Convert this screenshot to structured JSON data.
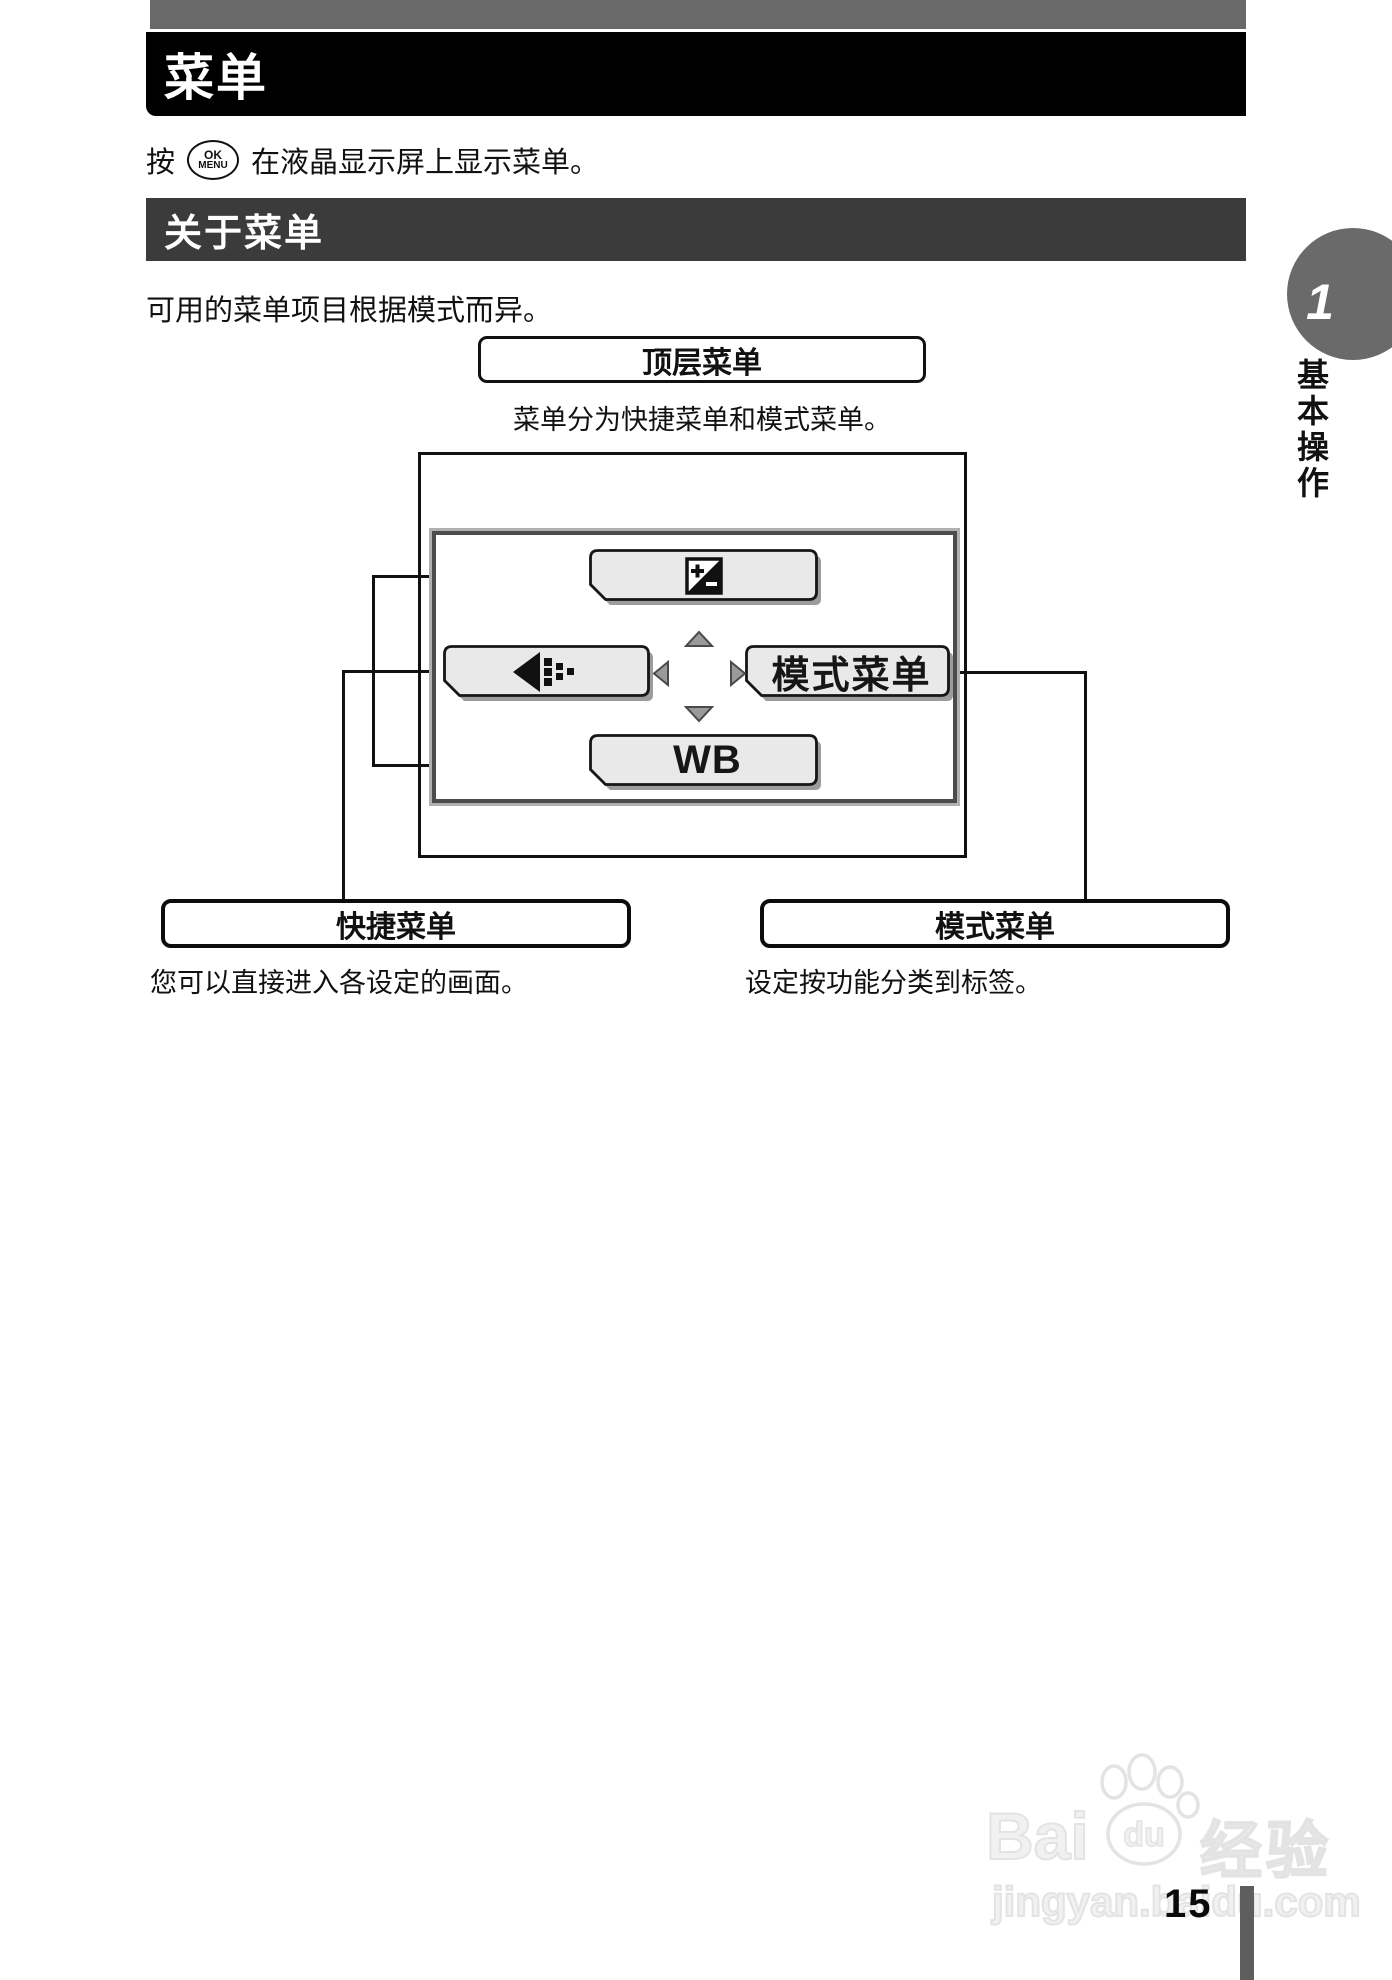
{
  "header": {
    "title": "菜单"
  },
  "intro": {
    "prefix": "按",
    "button_top": "OK",
    "button_bottom": "MENU",
    "suffix": "在液晶显示屏上显示菜单。"
  },
  "section": {
    "title": "关于菜单",
    "body": "可用的菜单项目根据模式而异。"
  },
  "top_menu": {
    "label": "顶层菜单",
    "caption": "菜单分为快捷菜单和模式菜单。"
  },
  "screen": {
    "mode_menu_label": "模式菜单",
    "wb_label": "WB"
  },
  "callouts": {
    "shortcut_label": "快捷菜单",
    "shortcut_caption": "您可以直接进入各设定的画面。",
    "mode_label": "模式菜单",
    "mode_caption": "设定按功能分类到标签。"
  },
  "sidebar": {
    "chapter_number": "1",
    "chapter_title": "基本操作"
  },
  "watermark": {
    "brand_prefix": "Bai",
    "brand_paw_text": "du",
    "brand_cn": "经验",
    "url": "jingyan.baidu.com"
  },
  "footer": {
    "page_number": "15"
  },
  "icons": {
    "ok_menu": "ok-menu-button-icon",
    "exposure": "exposure-compensation-icon",
    "quality": "image-quality-icon",
    "up": "up-arrow-icon",
    "down": "down-arrow-icon",
    "left": "left-arrow-icon",
    "right": "right-arrow-icon",
    "paw": "baidu-paw-icon"
  },
  "colors": {
    "title_bar": "#000000",
    "section_bar": "#3b3b3b",
    "top_rule": "#696969",
    "chapter_tab": "#6a6a6a",
    "button_face": "#e9e9e9",
    "button_shadow": "#9c9c9c"
  }
}
